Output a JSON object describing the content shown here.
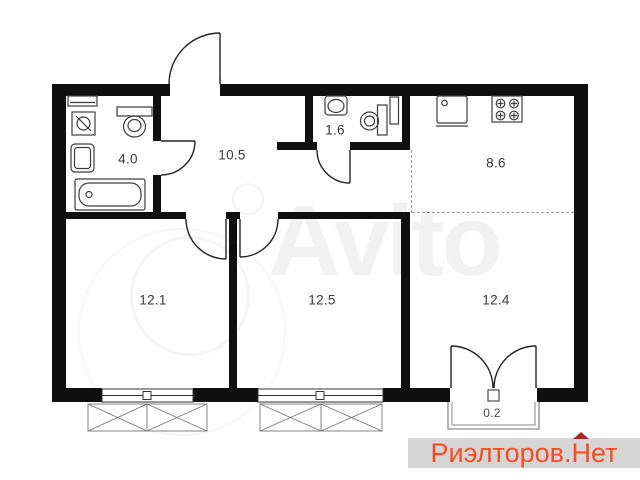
{
  "floorplan": {
    "type": "apartment-floor-plan",
    "rooms": [
      {
        "id": "bathroom",
        "area": "4.0"
      },
      {
        "id": "hallway",
        "area": "10.5"
      },
      {
        "id": "wc",
        "area": "1.6"
      },
      {
        "id": "kitchen",
        "area": "8.6"
      },
      {
        "id": "bedroom-1",
        "area": "12.1"
      },
      {
        "id": "bedroom-2",
        "area": "12.5"
      },
      {
        "id": "living-area",
        "area": "12.4"
      },
      {
        "id": "balcony",
        "area": "0.2"
      }
    ]
  },
  "watermark": {
    "text": "Avito"
  },
  "brand": {
    "prefix": "Риэлторов.",
    "house_letter": "Н",
    "suffix": "ет",
    "text_color": "#fb4a1e",
    "roof_color": "#a5291e",
    "background": "#d5d5d5"
  },
  "colors": {
    "wall": "#0f0f0f",
    "fixture_stroke": "#3d3d3d",
    "label": "#3a3a3a",
    "dashed_line": "#9a9a9a",
    "background": "#ffffff"
  }
}
